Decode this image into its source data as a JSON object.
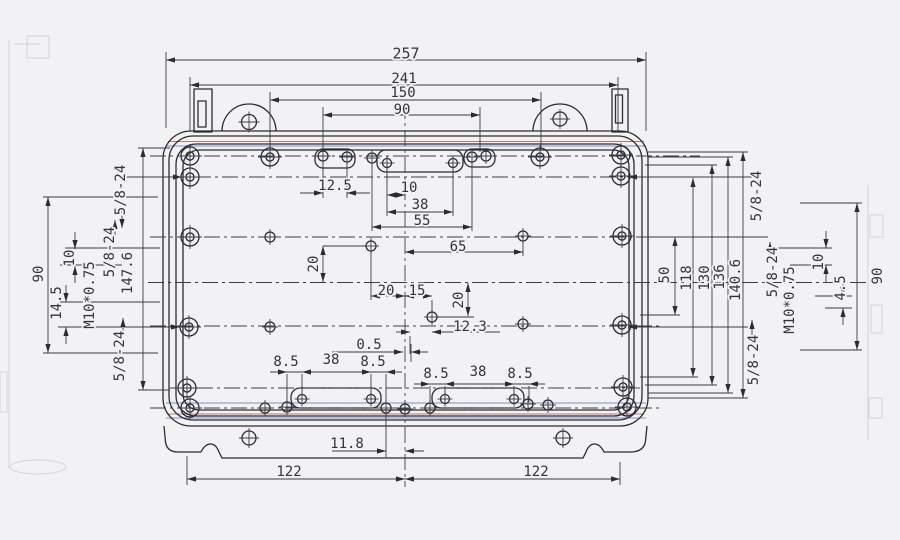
{
  "drawing_type": "engineering dimension drawing - enclosure base plan view",
  "colors": {
    "line": "#2b2b33",
    "centerline": "#3c3c46",
    "text": "#33333d",
    "background": "#f2f2f4",
    "scan_artifact_red": "#b2574b",
    "scan_artifact_blue": "#5d6fb0"
  },
  "dimensions_summary": {
    "top_widths": [
      "257",
      "241",
      "150",
      "90"
    ],
    "bottom_widths": [
      "122",
      "122",
      "11.8"
    ],
    "right_heights": [
      "50",
      "118",
      "130",
      "136",
      "140.6",
      "90"
    ],
    "left_heights": [
      "90",
      "147.6",
      "14.5",
      "10"
    ],
    "interior": [
      "12.5",
      "10",
      "38",
      "55",
      "65",
      "20",
      "20",
      "15",
      "20",
      "12.3",
      "0.5",
      "8.5",
      "38",
      "8.5",
      "8.5",
      "38",
      "8.5"
    ],
    "thread_callouts": [
      "5/8-24",
      "M10*0.75"
    ]
  },
  "labels": [
    {
      "id": "dim-257",
      "t": "257",
      "x": 406,
      "y": 54,
      "s": 15
    },
    {
      "id": "dim-241",
      "t": "241",
      "x": 404,
      "y": 79
    },
    {
      "id": "dim-150",
      "t": "150",
      "x": 403,
      "y": 93
    },
    {
      "id": "dim-90-top",
      "t": "90",
      "x": 402,
      "y": 110
    },
    {
      "id": "dim-12p5",
      "t": "12.5",
      "x": 335,
      "y": 186
    },
    {
      "id": "dim-10-top",
      "t": "10",
      "x": 409,
      "y": 188
    },
    {
      "id": "dim-38-top",
      "t": "38",
      "x": 420,
      "y": 205
    },
    {
      "id": "dim-55",
      "t": "55",
      "x": 422,
      "y": 221
    },
    {
      "id": "dim-65",
      "t": "65",
      "x": 458,
      "y": 247
    },
    {
      "id": "dim-20-a",
      "t": "20",
      "x": 314,
      "y": 264,
      "r": -90
    },
    {
      "id": "dim-20-b",
      "t": "20",
      "x": 386,
      "y": 291
    },
    {
      "id": "dim-15",
      "t": "15",
      "x": 417,
      "y": 291
    },
    {
      "id": "dim-20-c",
      "t": "20",
      "x": 459,
      "y": 300,
      "r": -90
    },
    {
      "id": "dim-12p3",
      "t": "12.3",
      "x": 470,
      "y": 327
    },
    {
      "id": "dim-0p5",
      "t": "0.5",
      "x": 369,
      "y": 345
    },
    {
      "id": "dim-8p5-a",
      "t": "8.5",
      "x": 286,
      "y": 362
    },
    {
      "id": "dim-38-bl",
      "t": "38",
      "x": 331,
      "y": 360
    },
    {
      "id": "dim-8p5-b",
      "t": "8.5",
      "x": 373,
      "y": 362
    },
    {
      "id": "dim-8p5-c",
      "t": "8.5",
      "x": 436,
      "y": 374
    },
    {
      "id": "dim-38-br",
      "t": "38",
      "x": 478,
      "y": 372
    },
    {
      "id": "dim-8p5-d",
      "t": "8.5",
      "x": 520,
      "y": 374
    },
    {
      "id": "dim-11p8",
      "t": "11.8",
      "x": 347,
      "y": 444
    },
    {
      "id": "dim-122-l",
      "t": "122",
      "x": 289,
      "y": 472
    },
    {
      "id": "dim-122-r",
      "t": "122",
      "x": 536,
      "y": 472
    },
    {
      "id": "thread-l-top",
      "t": "5/8-24",
      "x": 121,
      "y": 190,
      "r": -90
    },
    {
      "id": "thread-l-mid",
      "t": "5/8-24",
      "x": 110,
      "y": 252,
      "r": -90
    },
    {
      "id": "dim-90-left",
      "t": "90",
      "x": 39,
      "y": 274,
      "r": -90
    },
    {
      "id": "dim-10-left",
      "t": "10",
      "x": 70,
      "y": 258,
      "r": -90
    },
    {
      "id": "dim-14p5",
      "t": "14.5",
      "x": 57,
      "y": 303,
      "r": -90
    },
    {
      "id": "thread-l-m10",
      "t": "M10*0.75",
      "x": 90,
      "y": 295,
      "r": -90
    },
    {
      "id": "dim-147p6",
      "t": "147.6",
      "x": 128,
      "y": 273,
      "r": -90
    },
    {
      "id": "thread-l-bot",
      "t": "5/8-24",
      "x": 120,
      "y": 356,
      "r": -90
    },
    {
      "id": "dim-50",
      "t": "50",
      "x": 665,
      "y": 275,
      "r": -90
    },
    {
      "id": "dim-118",
      "t": "118",
      "x": 687,
      "y": 278,
      "r": -90
    },
    {
      "id": "dim-130",
      "t": "130",
      "x": 705,
      "y": 278,
      "r": -90
    },
    {
      "id": "dim-136",
      "t": "136",
      "x": 720,
      "y": 277,
      "r": -90
    },
    {
      "id": "dim-140p6",
      "t": "140.6",
      "x": 736,
      "y": 280,
      "r": -90
    },
    {
      "id": "thread-r-top",
      "t": "5/8-24",
      "x": 757,
      "y": 196,
      "r": -90
    },
    {
      "id": "thread-r-mid",
      "t": "5/8-24",
      "x": 773,
      "y": 272,
      "r": -90
    },
    {
      "id": "thread-r-m10",
      "t": "M10*0.75",
      "x": 790,
      "y": 300,
      "r": -90
    },
    {
      "id": "dim-10-right",
      "t": "10",
      "x": 819,
      "y": 262,
      "r": -90
    },
    {
      "id": "dim-4p5",
      "t": "4.5",
      "x": 841,
      "y": 288,
      "r": -90
    },
    {
      "id": "dim-90-right",
      "t": "90",
      "x": 878,
      "y": 276,
      "r": -90
    },
    {
      "id": "thread-r-bot",
      "t": "5/8-24",
      "x": 754,
      "y": 360,
      "r": -90
    }
  ]
}
